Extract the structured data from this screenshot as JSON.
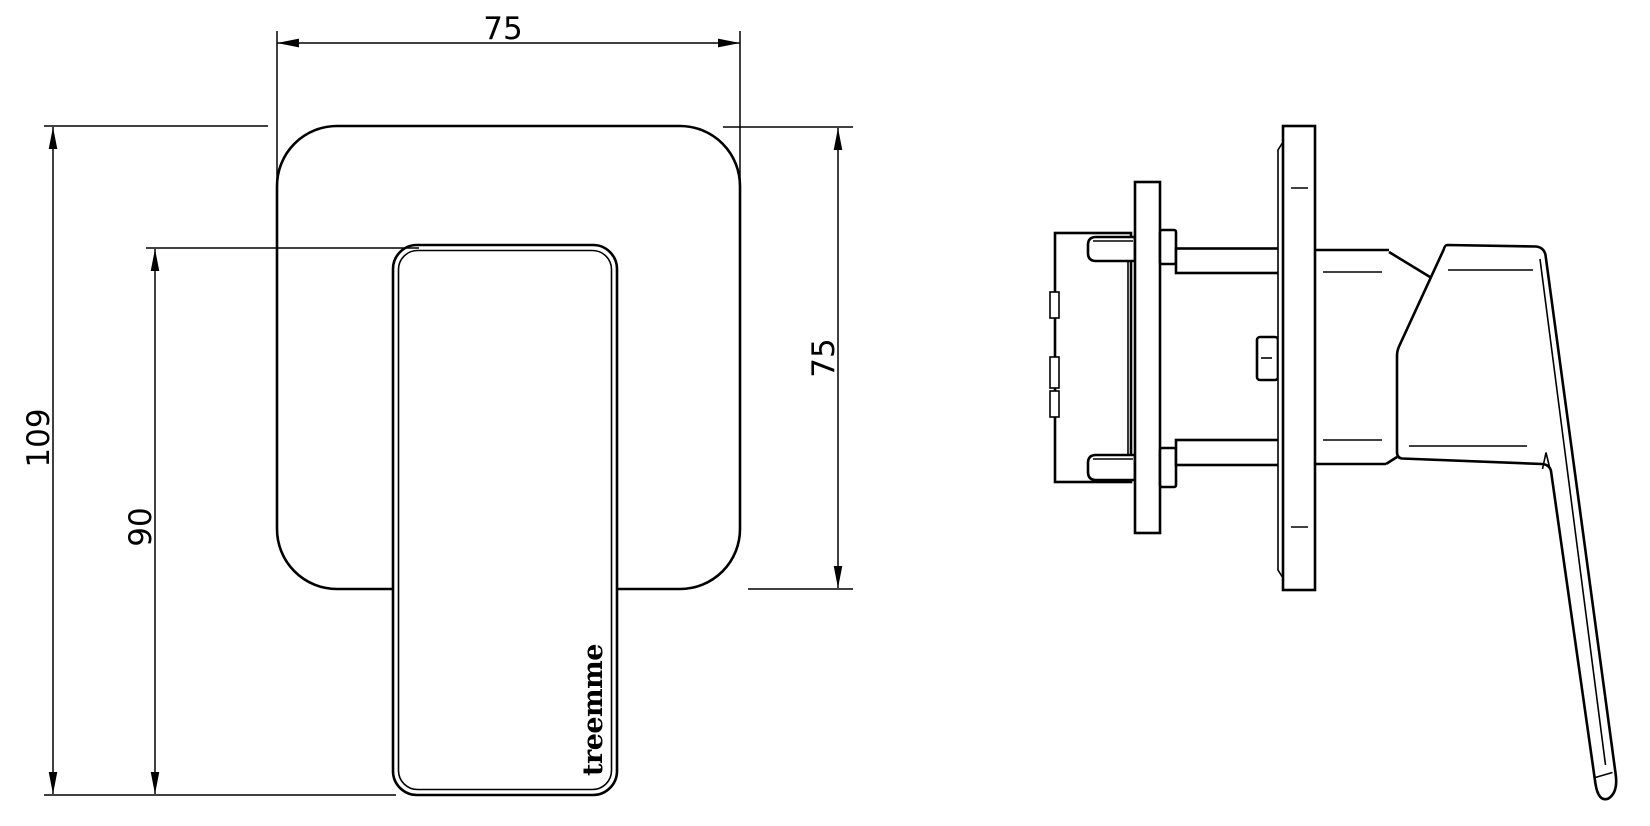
{
  "drawing": {
    "background": "#ffffff",
    "stroke_color": "#000000",
    "front_view": {
      "brand_label": "treemme",
      "dimensions": {
        "top_width": "75",
        "overall_height": "109",
        "handle_height": "90",
        "plate_height": "75"
      }
    }
  }
}
